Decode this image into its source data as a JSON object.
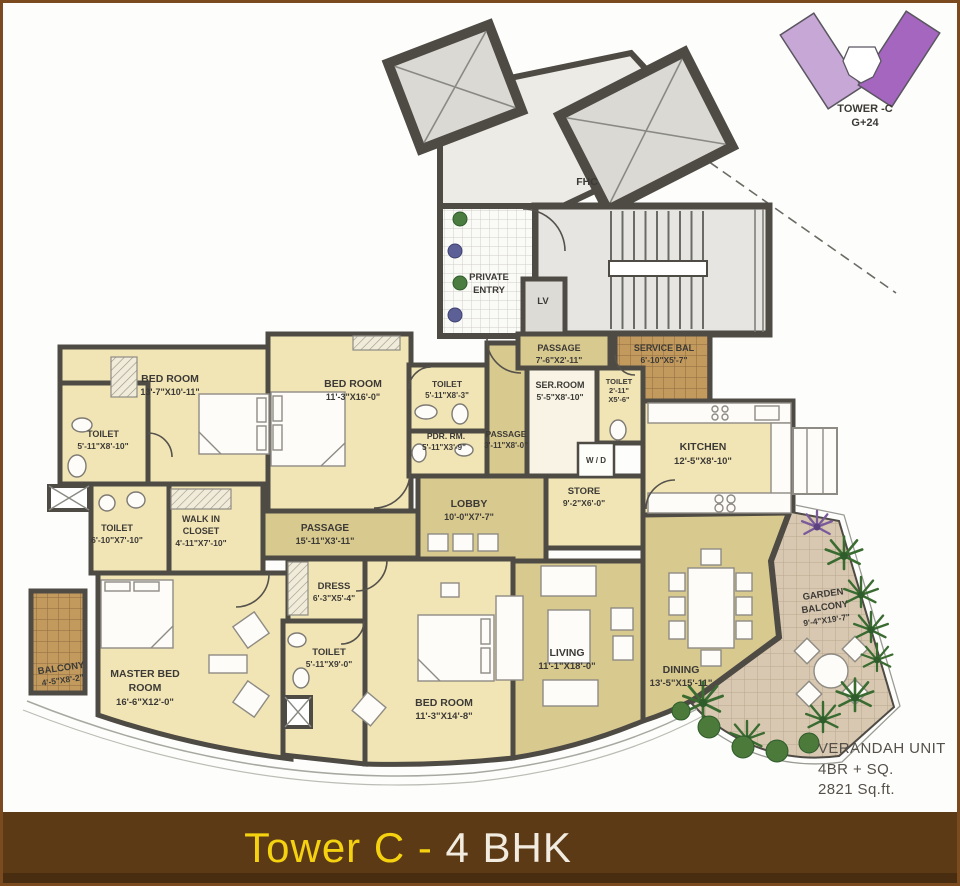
{
  "key_plan": {
    "title": "TOWER -C",
    "subtitle": "G+24"
  },
  "banner": {
    "title_part1": "Tower C - ",
    "title_part2": "4 BHK"
  },
  "unit_info": {
    "line1": "VERANDAH UNIT",
    "line2": "4BR + SQ.",
    "line3": "2821 Sq.ft."
  },
  "common": {
    "fhc": "FHC",
    "private_entry_l1": "PRIVATE",
    "private_entry_l2": "ENTRY",
    "lv": "LV"
  },
  "rooms": {
    "bedroom1": {
      "name": "BED ROOM",
      "dims": "13'-7\"X10'-11\""
    },
    "toilet1": {
      "name": "TOILET",
      "dims": "5'-11\"X8'-10\""
    },
    "bedroom2": {
      "name": "BED ROOM",
      "dims": "11'-3\"X16'-0\""
    },
    "toilet2": {
      "name": "TOILET",
      "dims": "5'-11\"X8'-3\""
    },
    "pdr": {
      "name": "PDR. RM.",
      "dims": "5'-11\"X3'-9\""
    },
    "passage2": {
      "name": "PASSAGE",
      "dims": "3'-11\"X8'-0\""
    },
    "passage_top": {
      "name": "PASSAGE",
      "dims": "7'-6\"X2'-11\""
    },
    "service_balcony": {
      "name": "SERVICE BAL",
      "dims": "6'-10\"X5'-7\""
    },
    "servant_room": {
      "name": "SER.ROOM",
      "dims": "5'-5\"X8'-10\""
    },
    "toilet_service": {
      "name": "TOILET",
      "dims_l1": "2'-11\"",
      "dims_l2": "X5'-6\""
    },
    "kitchen": {
      "name": "KITCHEN",
      "dims": "12'-5\"X8'-10\""
    },
    "wd": {
      "name": "W / D"
    },
    "store": {
      "name": "STORE",
      "dims": "9'-2\"X6'-0\""
    },
    "lobby": {
      "name": "LOBBY",
      "dims": "10'-0\"X7'-7\""
    },
    "passage_main": {
      "name": "PASSAGE",
      "dims": "15'-11\"X3'-11\""
    },
    "toilet3": {
      "name": "TOILET",
      "dims": "6'-10\"X7'-10\""
    },
    "walkin_closet": {
      "name_l1": "WALK IN",
      "name_l2": "CLOSET",
      "dims": "4'-11\"X7'-10\""
    },
    "master_bedroom": {
      "name_l1": "MASTER BED",
      "name_l2": "ROOM",
      "dims": "16'-6\"X12'-0\""
    },
    "balcony": {
      "name": "BALCONY",
      "dims": "4'-5\"X8'-2\""
    },
    "dress": {
      "name": "DRESS",
      "dims": "6'-3\"X5'-4\""
    },
    "toilet4": {
      "name": "TOILET",
      "dims": "5'-11\"X9'-0\""
    },
    "bedroom3": {
      "name": "BED ROOM",
      "dims": "11'-3\"X14'-8\""
    },
    "living": {
      "name": "LIVING",
      "dims": "11'-1\"X18'-0\""
    },
    "dining": {
      "name": "DINING",
      "dims": "13'-5\"X15'-11\""
    },
    "garden_balcony": {
      "name_l1": "GARDEN",
      "name_l2": "BALCONY",
      "dims": "9'-4\"X19'-7\""
    }
  },
  "colors": {
    "banner_bg": "#5d3a16",
    "banner_yellow": "#f5d20f",
    "banner_white": "#f2ece0",
    "wall": "#4e4a44",
    "room_cream": "#f2e5b5",
    "room_khaki": "#d8c98f",
    "balcony_brown": "#c29a5e",
    "garden_tan": "#d8c8b1",
    "tower_purple_light": "#c7a7d6",
    "tower_purple_dark": "#a466bf"
  }
}
